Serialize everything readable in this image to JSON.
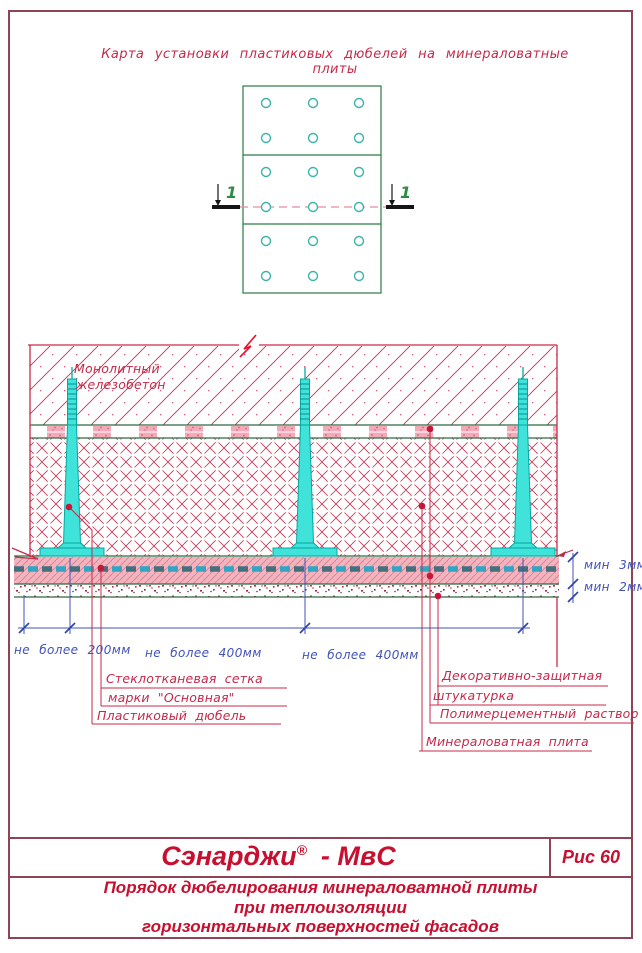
{
  "sheet": {
    "title": "Карта установки пластиковых дюбелей на минераловатные плиты"
  },
  "plan": {
    "cut_label": "1",
    "plates": 3,
    "dowel_columns": 3,
    "dowel_rows": 6
  },
  "section": {
    "labels": {
      "concrete_l1": "Монолитный",
      "concrete_l2": "железобетон",
      "mesh_l1": "Стеклотканевая сетка",
      "mesh_l2": "марки \"Основная\"",
      "dowel": "Пластиковый дюбель",
      "plaster_l1": "Декоративно-защитная",
      "plaster_l2": "штукатурка",
      "mortar": "Полимерцементный раствор",
      "wool": "Минераловатная плита"
    },
    "dims": {
      "edge": "не более 200мм",
      "spacing1": "не более 400мм",
      "spacing2": "не более 400мм",
      "mortar_min": "мин 3мм",
      "plaster_min": "мин 2мм"
    }
  },
  "titleblock": {
    "brand": "Сэнарджи",
    "registered": "®",
    "brand_suffix": "- МвС",
    "figure": "Рис 60",
    "caption_l1": "Порядок дюбелирования минераловатной плиты",
    "caption_l2": "при  теплоизоляции",
    "caption_l3": "горизонтальных поверхностей фасадов"
  },
  "colors": {
    "frame": "#8e4454",
    "drawing_crimson": "#cb2a48",
    "layer_green": "#2c6b3e",
    "plan_green": "#2c7a44",
    "dowel_fill": "#3fe3d9",
    "dowel_edge": "#09a6a2",
    "dimension_blue": "#4152b8",
    "brand_red": "#c90f2f",
    "mesh_dark": "#44707e",
    "mesh_cyan": "#2fa6c4",
    "mortar_pink": "#f1b2bd",
    "cut_mark_green": "#2e8b44"
  }
}
